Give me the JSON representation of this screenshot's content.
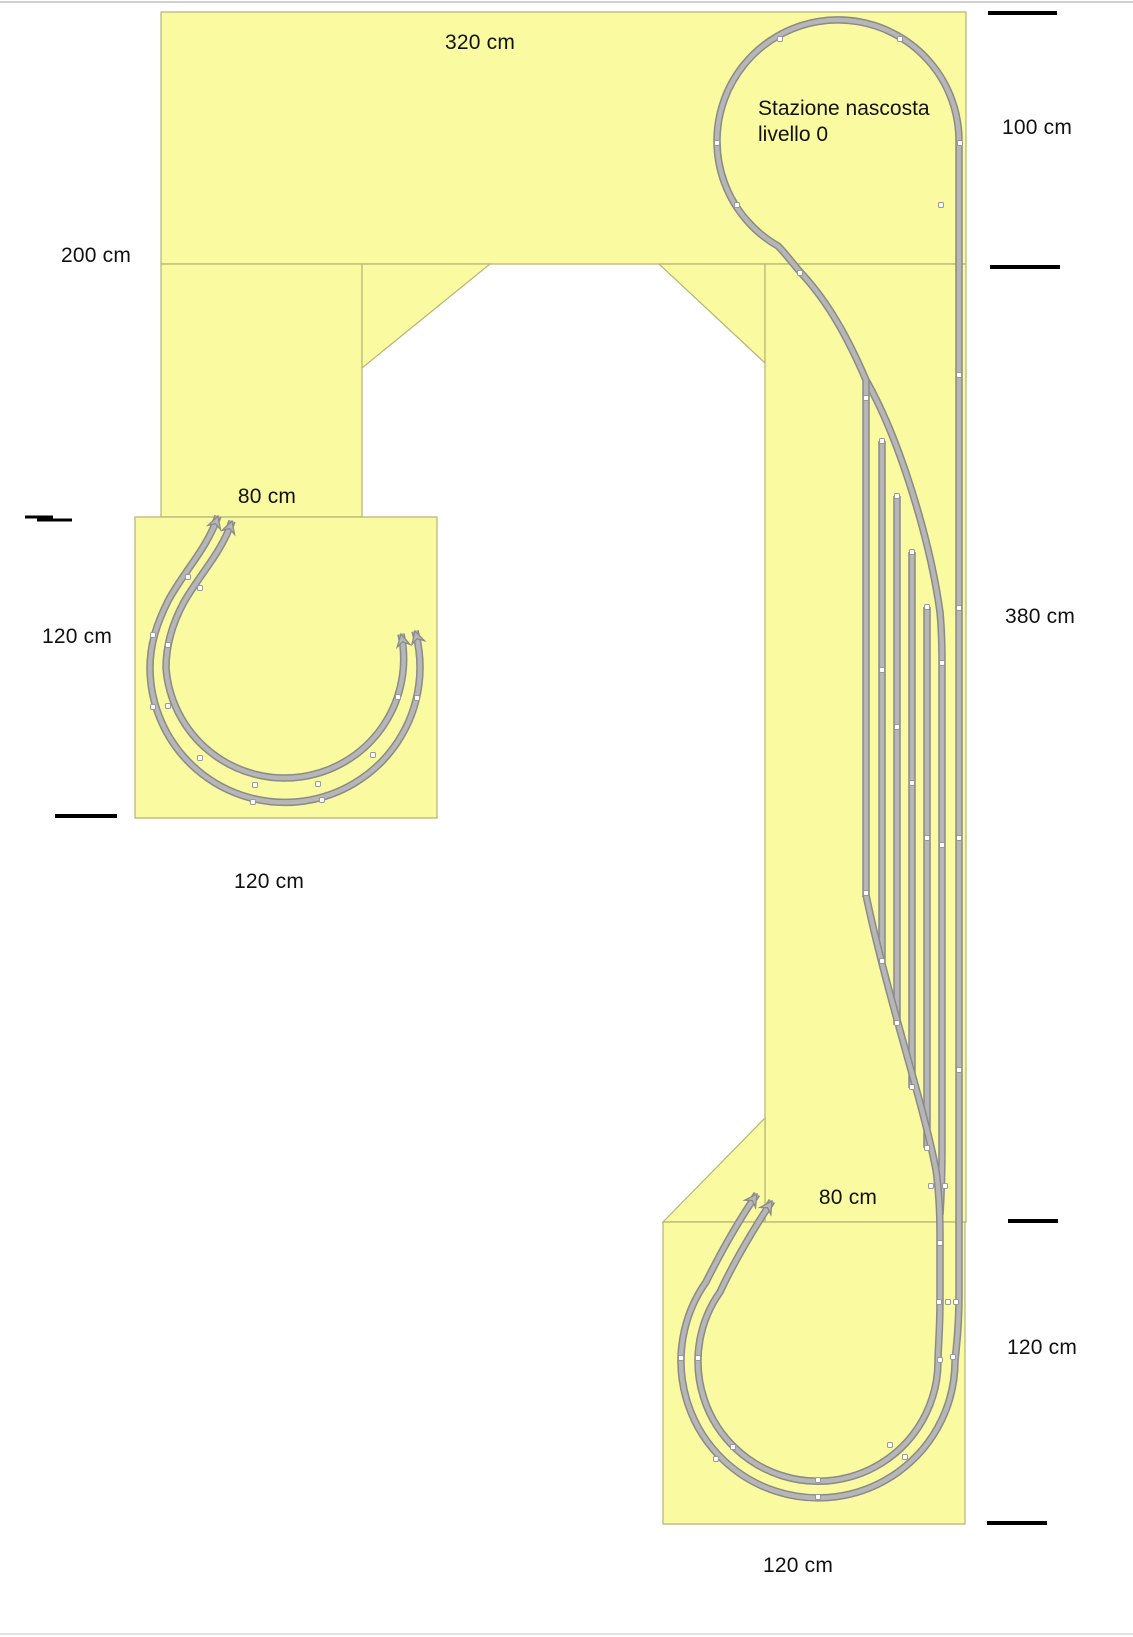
{
  "station_note": {
    "line1": "Stazione nascosta",
    "line2": "livello 0"
  },
  "dimension_labels": [
    {
      "id": "top-width-320",
      "text": "320 cm",
      "x": 480,
      "y": 43
    },
    {
      "id": "right-height-100",
      "text": "100 cm",
      "x": 1037,
      "y": 128
    },
    {
      "id": "left-height-200",
      "text": "200 cm",
      "x": 96,
      "y": 256
    },
    {
      "id": "left-column-width-80",
      "text": "80 cm",
      "x": 267,
      "y": 497
    },
    {
      "id": "left-square-height-120",
      "text": "120 cm",
      "x": 77,
      "y": 637
    },
    {
      "id": "right-height-380",
      "text": "380 cm",
      "x": 1040,
      "y": 617
    },
    {
      "id": "left-square-width-120",
      "text": "120 cm",
      "x": 269,
      "y": 882
    },
    {
      "id": "right-column-width-80",
      "text": "80 cm",
      "x": 848,
      "y": 1198
    },
    {
      "id": "right-height-120",
      "text": "120 cm",
      "x": 1042,
      "y": 1348
    },
    {
      "id": "bottom-square-width-120",
      "text": "120 cm",
      "x": 798,
      "y": 1566
    }
  ],
  "colors": {
    "panel_fill": "#fafaa0",
    "panel_stroke": "#b5b578",
    "track_edge": "#8a8a8a",
    "track_fill": "#b6b6b6",
    "joint_fill": "#ffffff",
    "joint_stroke": "#999999",
    "tick": "#000000",
    "label": "#111111",
    "page_line": "#c0c0c0"
  },
  "panels": [
    {
      "name": "top-deck",
      "points": "161,12 966,12 966,264 161,264"
    },
    {
      "name": "left-column",
      "points": "161,264 362,264 362,517 161,517"
    },
    {
      "name": "left-wing",
      "points": "362,264 490,264 362,368"
    },
    {
      "name": "left-square",
      "points": "135,517 437,517 437,818 135,818"
    },
    {
      "name": "right-wing",
      "points": "659,264 765,264 765,363"
    },
    {
      "name": "right-column",
      "points": "765,264 966,264 966,1222 765,1222"
    },
    {
      "name": "bottom-wing",
      "points": "765,1118 765,1222 663,1222"
    },
    {
      "name": "bottom-square",
      "points": "663,1222 965,1222 965,1524 663,1524"
    }
  ],
  "tracks": [
    {
      "name": "hidden-station-balloon-and-mainline",
      "d": "M 866,380 C 848,338 828,302 802,274 C 793,264 786,254 778,246 A 121,121 0 1 1 959,141 L 959,1295 C 959,1332 956,1348 955,1362 A 137,137 0 1 1 706,1282 C 721,1252 739,1220 757,1194",
      "arrow_end": true
    },
    {
      "name": "yard-ladder-top",
      "d": "M 866,380 C 900,440 930,540 940,612 C 942,634 942,648 942,663"
    },
    {
      "name": "yard-track-1",
      "d": "M 866,380 L 866,897"
    },
    {
      "name": "yard-track-2",
      "d": "M 882,441 L 882,963"
    },
    {
      "name": "yard-track-3",
      "d": "M 897,496 L 897,1025"
    },
    {
      "name": "yard-track-4",
      "d": "M 912,552 L 912,1088"
    },
    {
      "name": "yard-track-5",
      "d": "M 927,607 L 927,1148"
    },
    {
      "name": "yard-track-6",
      "d": "M 942,663 L 942,1150 C 942,1180 941,1198 940,1215"
    },
    {
      "name": "yard-lead-and-inner-loop",
      "d": "M 866,895 C 888,1000 922,1098 936,1170 C 939,1192 940,1210 940,1235 L 940,1300 C 940,1332 938,1347 938,1362 A 120,120 0 1 1 720,1292 C 734,1262 753,1230 772,1201",
      "arrow_end": true
    },
    {
      "name": "left-square-outer-curve",
      "d": "M 218,516 C 207,549 184,571 168,601 C 157,623 150,644 150,668 A 135,135 0 1 0 415,631",
      "arrow_start": true,
      "arrow_end": true
    },
    {
      "name": "left-square-inner-curve",
      "d": "M 232,521 C 222,552 200,574 184,602 C 172,624 166,645 166,668 A 119,119 0 1 0 401,634",
      "arrow_start": true,
      "arrow_end": true
    }
  ],
  "joints": [
    [
      780,
      39
    ],
    [
      900,
      39
    ],
    [
      717,
      143
    ],
    [
      960,
      143
    ],
    [
      737,
      205
    ],
    [
      941,
      205
    ],
    [
      800,
      273
    ],
    [
      959,
      375
    ],
    [
      959,
      608
    ],
    [
      959,
      838
    ],
    [
      959,
      1070
    ],
    [
      866,
      398
    ],
    [
      882,
      441
    ],
    [
      897,
      496
    ],
    [
      912,
      552
    ],
    [
      927,
      607
    ],
    [
      942,
      663
    ],
    [
      882,
      670
    ],
    [
      897,
      727
    ],
    [
      912,
      783
    ],
    [
      927,
      838
    ],
    [
      942,
      845
    ],
    [
      866,
      893
    ],
    [
      882,
      961
    ],
    [
      897,
      1023
    ],
    [
      912,
      1087
    ],
    [
      927,
      1148
    ],
    [
      931,
      1186
    ],
    [
      945,
      1186
    ],
    [
      940,
      1243
    ],
    [
      939,
      1302
    ],
    [
      948,
      1302
    ],
    [
      956,
      1302
    ],
    [
      940,
      1360
    ],
    [
      953,
      1357
    ],
    [
      681,
      1358
    ],
    [
      716,
      1459
    ],
    [
      818,
      1497
    ],
    [
      905,
      1457
    ],
    [
      698,
      1358
    ],
    [
      733,
      1447
    ],
    [
      818,
      1480
    ],
    [
      890,
      1445
    ],
    [
      188,
      577
    ],
    [
      153,
      635
    ],
    [
      153,
      707
    ],
    [
      200,
      758
    ],
    [
      253,
      802
    ],
    [
      322,
      800
    ],
    [
      373,
      755
    ],
    [
      417,
      698
    ],
    [
      200,
      588
    ],
    [
      168,
      645
    ],
    [
      168,
      706
    ],
    [
      255,
      785
    ],
    [
      318,
      784
    ],
    [
      398,
      697
    ]
  ],
  "ticks": [
    {
      "x1": 988,
      "y1": 13,
      "x2": 1057,
      "y2": 13,
      "w": 4
    },
    {
      "x1": 990,
      "y1": 267,
      "x2": 1060,
      "y2": 267,
      "w": 4
    },
    {
      "x1": 1008,
      "y1": 1221,
      "x2": 1058,
      "y2": 1221,
      "w": 4
    },
    {
      "x1": 987,
      "y1": 1523,
      "x2": 1047,
      "y2": 1523,
      "w": 4
    },
    {
      "x1": 25,
      "y1": 517,
      "x2": 53,
      "y2": 517,
      "w": 3
    },
    {
      "x1": 37,
      "y1": 520,
      "x2": 72,
      "y2": 520,
      "w": 3
    },
    {
      "x1": 55,
      "y1": 816,
      "x2": 117,
      "y2": 816,
      "w": 4
    }
  ],
  "page_lines": [
    {
      "y": 2,
      "color": "#c0c0c0"
    },
    {
      "y": 1634,
      "color": "#dcdcdc"
    }
  ]
}
